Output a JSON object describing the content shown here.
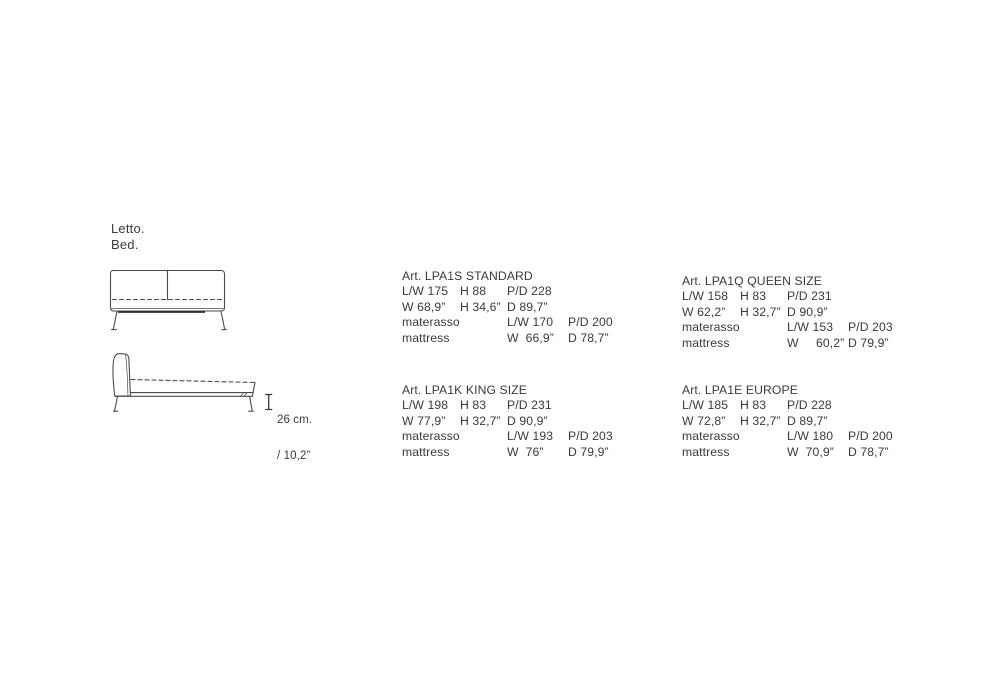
{
  "page": {
    "title_line1": "Letto.",
    "title_line2": "Bed.",
    "background": "#ffffff",
    "ink_color": "#3a3a3a",
    "line_color": "#4a4a4a"
  },
  "side_view_dimension": {
    "metric": "26 cm.",
    "imperial": "/ 10,2”"
  },
  "spec_blocks": [
    {
      "art": "Art. LPA1S STANDARD",
      "frame_cm": [
        "L/W 175",
        "H 88",
        "P/D 228"
      ],
      "frame_in": [
        "W 68,9”",
        "H 34,6”",
        "D 89,7”"
      ],
      "mattress_cm": [
        "materasso",
        "L/W 170",
        "P/D 200"
      ],
      "mattress_in": [
        "mattress",
        "W  66,9”",
        "D 78,7”"
      ]
    },
    {
      "art": "Art. LPA1Q QUEEN SIZE",
      "frame_cm": [
        "L/W 158",
        "H 83",
        "P/D 231"
      ],
      "frame_in": [
        "W 62,2”",
        "H 32,7”",
        "D 90,9”"
      ],
      "mattress_cm": [
        "materasso",
        "L/W 153",
        "P/D 203"
      ],
      "mattress_in": [
        "mattress",
        "W     60,2”",
        "D 79,9”"
      ]
    },
    {
      "art": "Art. LPA1K KING SIZE",
      "frame_cm": [
        "L/W 198",
        "H 83",
        "P/D 231"
      ],
      "frame_in": [
        "W 77,9”",
        "H 32,7”",
        "D 90,9”"
      ],
      "mattress_cm": [
        "materasso",
        "L/W 193",
        "P/D 203"
      ],
      "mattress_in": [
        "mattress",
        "W  76”",
        "D 79,9”"
      ]
    },
    {
      "art": "Art. LPA1E EUROPE",
      "frame_cm": [
        "L/W 185",
        "H 83",
        "P/D 228"
      ],
      "frame_in": [
        "W 72,8”",
        "H 32,7”",
        "D 89,7”"
      ],
      "mattress_cm": [
        "materasso",
        "L/W 180",
        "P/D 200"
      ],
      "mattress_in": [
        "mattress",
        "W  70,9”",
        "D 78,7”"
      ]
    }
  ]
}
